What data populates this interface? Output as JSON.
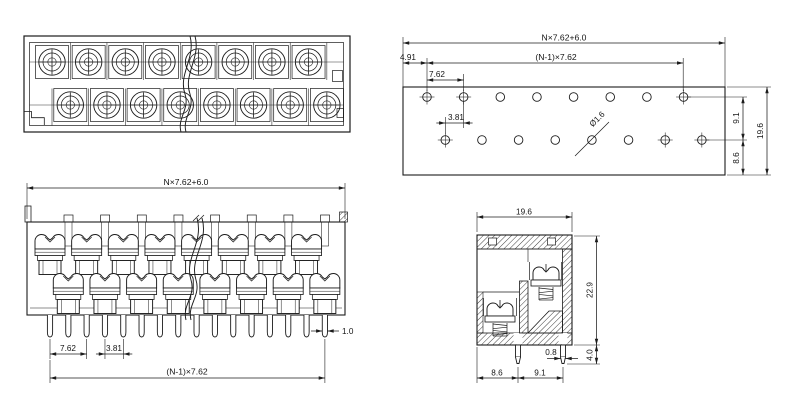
{
  "page": {
    "background": "#ffffff",
    "line_color": "#1c1c1c",
    "description": "terminal-block technical drawing, 4 views"
  },
  "views": {
    "top": {
      "rows": 2,
      "screws_per_row": 8
    },
    "footprint": {
      "rows": 2,
      "holes_per_row": 8,
      "dims": {
        "overall_width": "N×7.62+6.0",
        "edge_to_first_hole": "4.91",
        "hole_span": "(N-1)×7.62",
        "pitch": "7.62",
        "row_stagger": "3.81",
        "hole_diameter": "Ø1.6",
        "row_spacing": "9.1",
        "bottom_row_to_edge": "8.6",
        "overall_depth": "19.6"
      }
    },
    "front": {
      "poles_per_row": 8,
      "pin_count": 16,
      "dims": {
        "overall_width": "N×7.62+6.0",
        "pitch": "7.62",
        "pin_stagger": "3.81",
        "pin_span": "(N-1)×7.62",
        "pin_width": "1.0"
      }
    },
    "side": {
      "dims": {
        "depth": "19.6",
        "height": "22.9",
        "pin_length": "4.0",
        "pin_thickness": "0.8",
        "front_pin_to_edge": "8.6",
        "pin_row_spacing": "9.1"
      }
    }
  }
}
